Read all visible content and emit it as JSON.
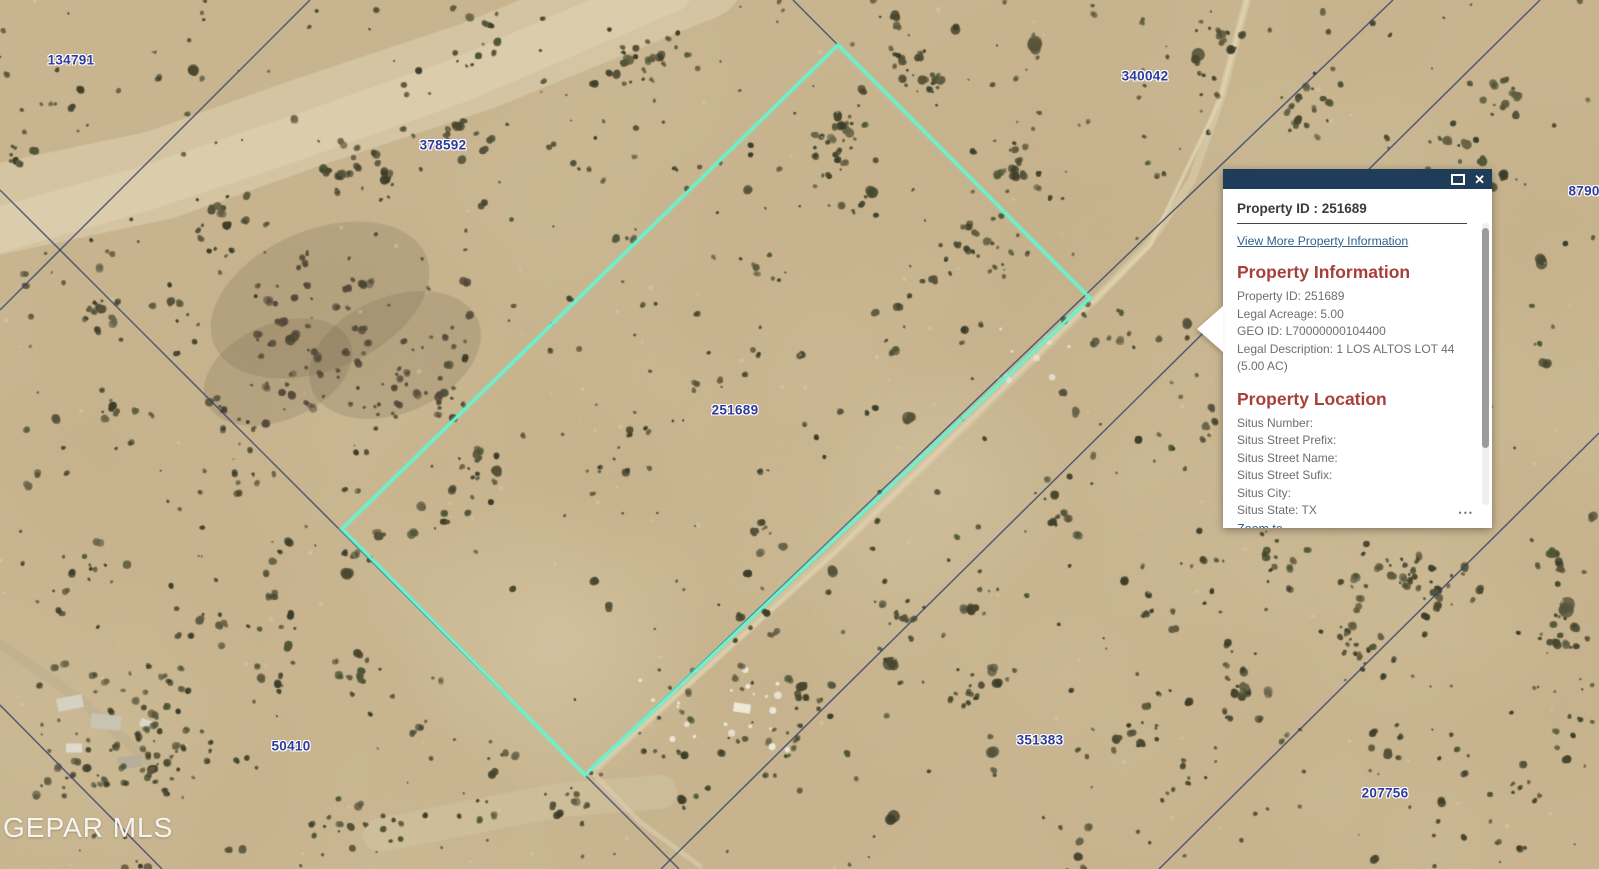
{
  "map": {
    "watermark": "GEPAR MLS",
    "label_color": "#2e3a9e",
    "selected_parcel_color": "#68f4cf",
    "parcel_line_color": "#35426e",
    "labels": [
      {
        "text": "134791",
        "x": 71,
        "y": 60
      },
      {
        "text": "378592",
        "x": 443,
        "y": 145
      },
      {
        "text": "340042",
        "x": 1145,
        "y": 76
      },
      {
        "text": "87903",
        "x": 1588,
        "y": 191
      },
      {
        "text": "251689",
        "x": 735,
        "y": 410
      },
      {
        "text": "50410",
        "x": 291,
        "y": 746
      },
      {
        "text": "351383",
        "x": 1040,
        "y": 740
      },
      {
        "text": "207756",
        "x": 1385,
        "y": 793
      }
    ],
    "selected_parcel": {
      "id": "251689",
      "corners": [
        [
          838,
          45
        ],
        [
          1090,
          298
        ],
        [
          585,
          775
        ],
        [
          342,
          529
        ]
      ]
    }
  },
  "popup": {
    "title": "Property ID : 251689",
    "view_more_link": "View More Property Information",
    "section_info": {
      "heading": "Property Information",
      "lines": [
        "Property ID: 251689",
        "Legal Acreage: 5.00",
        "GEO ID: L70000000104400",
        "Legal Description: 1 LOS ALTOS LOT 44 (5.00 AC)"
      ]
    },
    "section_location": {
      "heading": "Property Location",
      "lines": [
        "Situs Number:",
        "Situs Street Prefix:",
        "Situs Street Name:",
        "Situs Street Sufix:",
        "Situs City:",
        "Situs State: TX"
      ]
    },
    "zoom_to_link": "Zoom to",
    "icons": {
      "maximize": "maximize",
      "close": "✕",
      "more": "•••"
    },
    "colors": {
      "header_bg": "#1f3c58",
      "heading": "#a7403d",
      "link": "#31618d",
      "body_text": "#6e6e6e",
      "title_text": "#3a3a3a"
    }
  }
}
